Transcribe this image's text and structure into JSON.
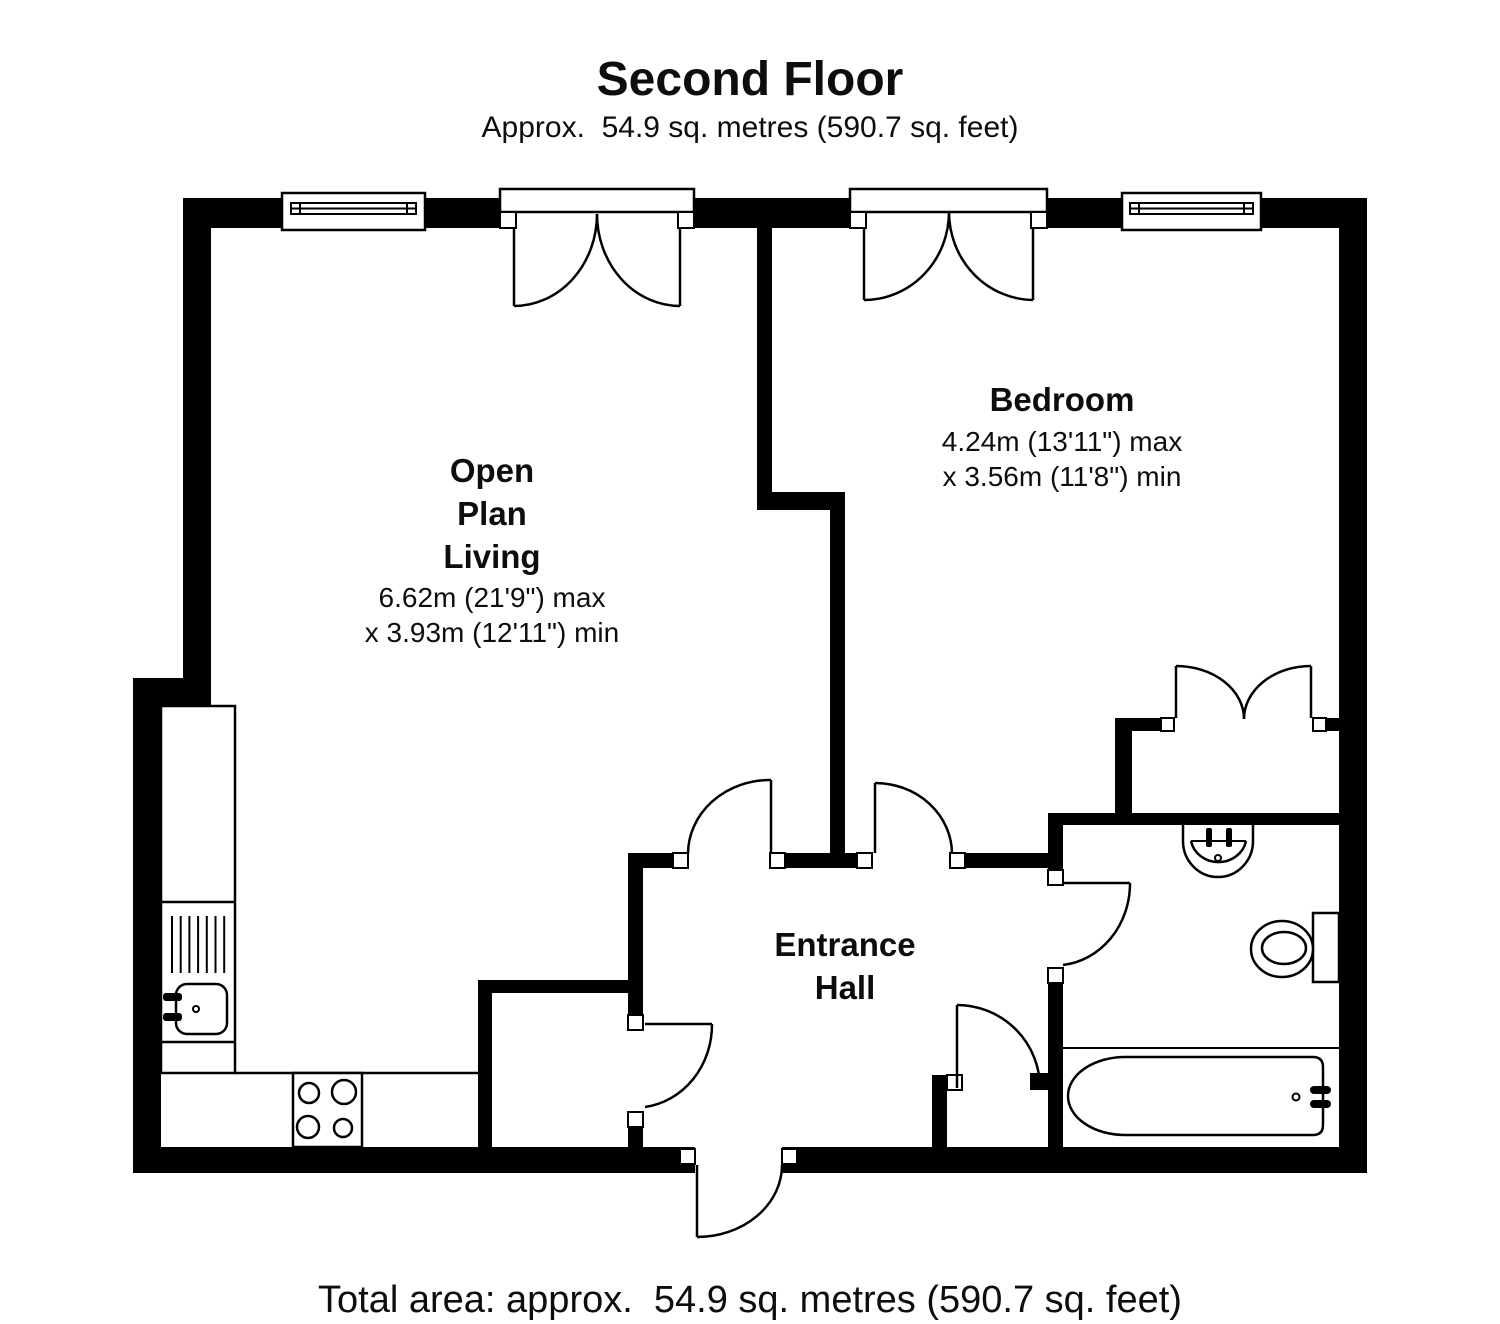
{
  "header": {
    "title": "Second Floor",
    "subtitle": "Approx.  54.9 sq. metres (590.7 sq. feet)"
  },
  "footer": {
    "total_area": "Total area: approx.  54.9 sq. metres (590.7 sq. feet)"
  },
  "rooms": {
    "living": {
      "line1": "Open",
      "line2": "Plan",
      "line3": "Living",
      "dim1": "6.62m (21'9\") max",
      "dim2": "x 3.93m (12'11\") min"
    },
    "bedroom": {
      "name": "Bedroom",
      "dim1": "4.24m (13'11\") max",
      "dim2": "x 3.56m (11'8\") min"
    },
    "entrance_hall": {
      "line1": "Entrance",
      "line2": "Hall"
    }
  },
  "fixtures": {
    "kitchen": [
      "counter",
      "sink-drainer",
      "sink",
      "hob"
    ],
    "bathroom": [
      "basin",
      "toilet",
      "bath"
    ]
  },
  "colors": {
    "wall": "#000000",
    "background": "#ffffff",
    "text": "#0d0d0d"
  }
}
